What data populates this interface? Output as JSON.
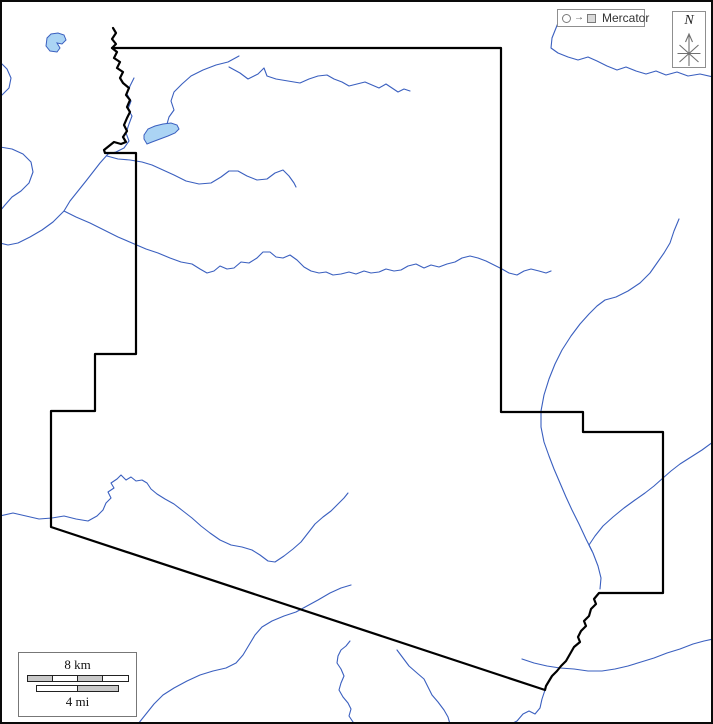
{
  "colors": {
    "river": "#3a5fbf",
    "lake_fill": "#abd4f4",
    "boundary": "#000000",
    "scale_segment_fill": "#c9c9c9",
    "box_border": "#8f8f8f",
    "glyph_gray": "#707070"
  },
  "projection_badge": {
    "label": "Mercator"
  },
  "compass": {
    "north_label": "N"
  },
  "scale_bar": {
    "top_label": "8 km",
    "bottom_label": "4 mi"
  },
  "credit": "© d-maps.com"
}
